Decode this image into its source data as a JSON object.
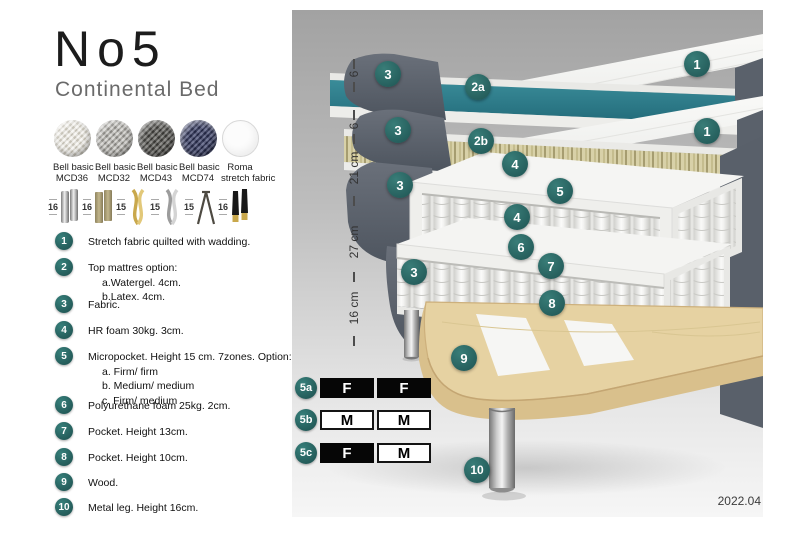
{
  "header": {
    "title": "No5",
    "subtitle": "Continental Bed"
  },
  "swatches": [
    {
      "line1": "Bell basic",
      "line2": "MCD36"
    },
    {
      "line1": "Bell basic",
      "line2": "MCD32"
    },
    {
      "line1": "Bell basic",
      "line2": "MCD43"
    },
    {
      "line1": "Bell basic",
      "line2": "MCD74"
    },
    {
      "line1": "Roma",
      "line2": "stretch fabric"
    }
  ],
  "legs": [
    {
      "height": "16"
    },
    {
      "height": "16"
    },
    {
      "height": "15"
    },
    {
      "height": "15"
    },
    {
      "height": "15"
    },
    {
      "height": "16"
    }
  ],
  "list": {
    "items": [
      {
        "num": "1",
        "text": "Stretch fabric quilted with wadding.",
        "subs": []
      },
      {
        "num": "2",
        "text": "Top mattres option:",
        "subs": [
          "a.Watergel. 4cm.",
          "b.Latex. 4cm."
        ]
      },
      {
        "num": "3",
        "text": "Fabric.",
        "subs": []
      },
      {
        "num": "4",
        "text": "HR foam 30kg. 3cm.",
        "subs": []
      },
      {
        "num": "5",
        "text": "Micropocket. Height 15 cm. 7zones. Option:",
        "subs": [
          "a. Firm/ firm",
          "b. Medium/ medium",
          "c. Firm/ medium"
        ]
      },
      {
        "num": "6",
        "text": "Polyurethane foam 25kg. 2cm.",
        "subs": []
      },
      {
        "num": "7",
        "text": "Pocket. Height 13cm.",
        "subs": []
      },
      {
        "num": "8",
        "text": "Pocket. Height 10cm.",
        "subs": []
      },
      {
        "num": "9",
        "text": "Wood.",
        "subs": []
      },
      {
        "num": "10",
        "text": "Metal leg. Height 16cm.",
        "subs": []
      }
    ]
  },
  "diagram": {
    "scale": [
      {
        "label": "6"
      },
      {
        "label": "6"
      },
      {
        "label": "21 cm"
      },
      {
        "label": "27 cm"
      },
      {
        "label": "16 cm"
      }
    ],
    "callouts": [
      {
        "label": "3"
      },
      {
        "label": "2a"
      },
      {
        "label": "1"
      },
      {
        "label": "3"
      },
      {
        "label": "2b"
      },
      {
        "label": "1"
      },
      {
        "label": "4"
      },
      {
        "label": "5"
      },
      {
        "label": "3"
      },
      {
        "label": "4"
      },
      {
        "label": "6"
      },
      {
        "label": "3"
      },
      {
        "label": "7"
      },
      {
        "label": "8"
      },
      {
        "label": "9"
      },
      {
        "label": "10"
      }
    ],
    "firmness": {
      "rows": [
        {
          "label": "5a",
          "cells": [
            {
              "text": "F"
            },
            {
              "text": "F"
            }
          ]
        },
        {
          "label": "5b",
          "cells": [
            {
              "text": "M"
            },
            {
              "text": "M"
            }
          ]
        },
        {
          "label": "5c",
          "cells": [
            {
              "text": "F"
            },
            {
              "text": "M"
            }
          ]
        }
      ]
    },
    "version": "2022.04"
  },
  "colors": {
    "accent_teal": "#2b6a67",
    "layer_teal": "#2d7c8b",
    "fabric_gray": "#59606a",
    "wood": "#e6d2a2"
  }
}
